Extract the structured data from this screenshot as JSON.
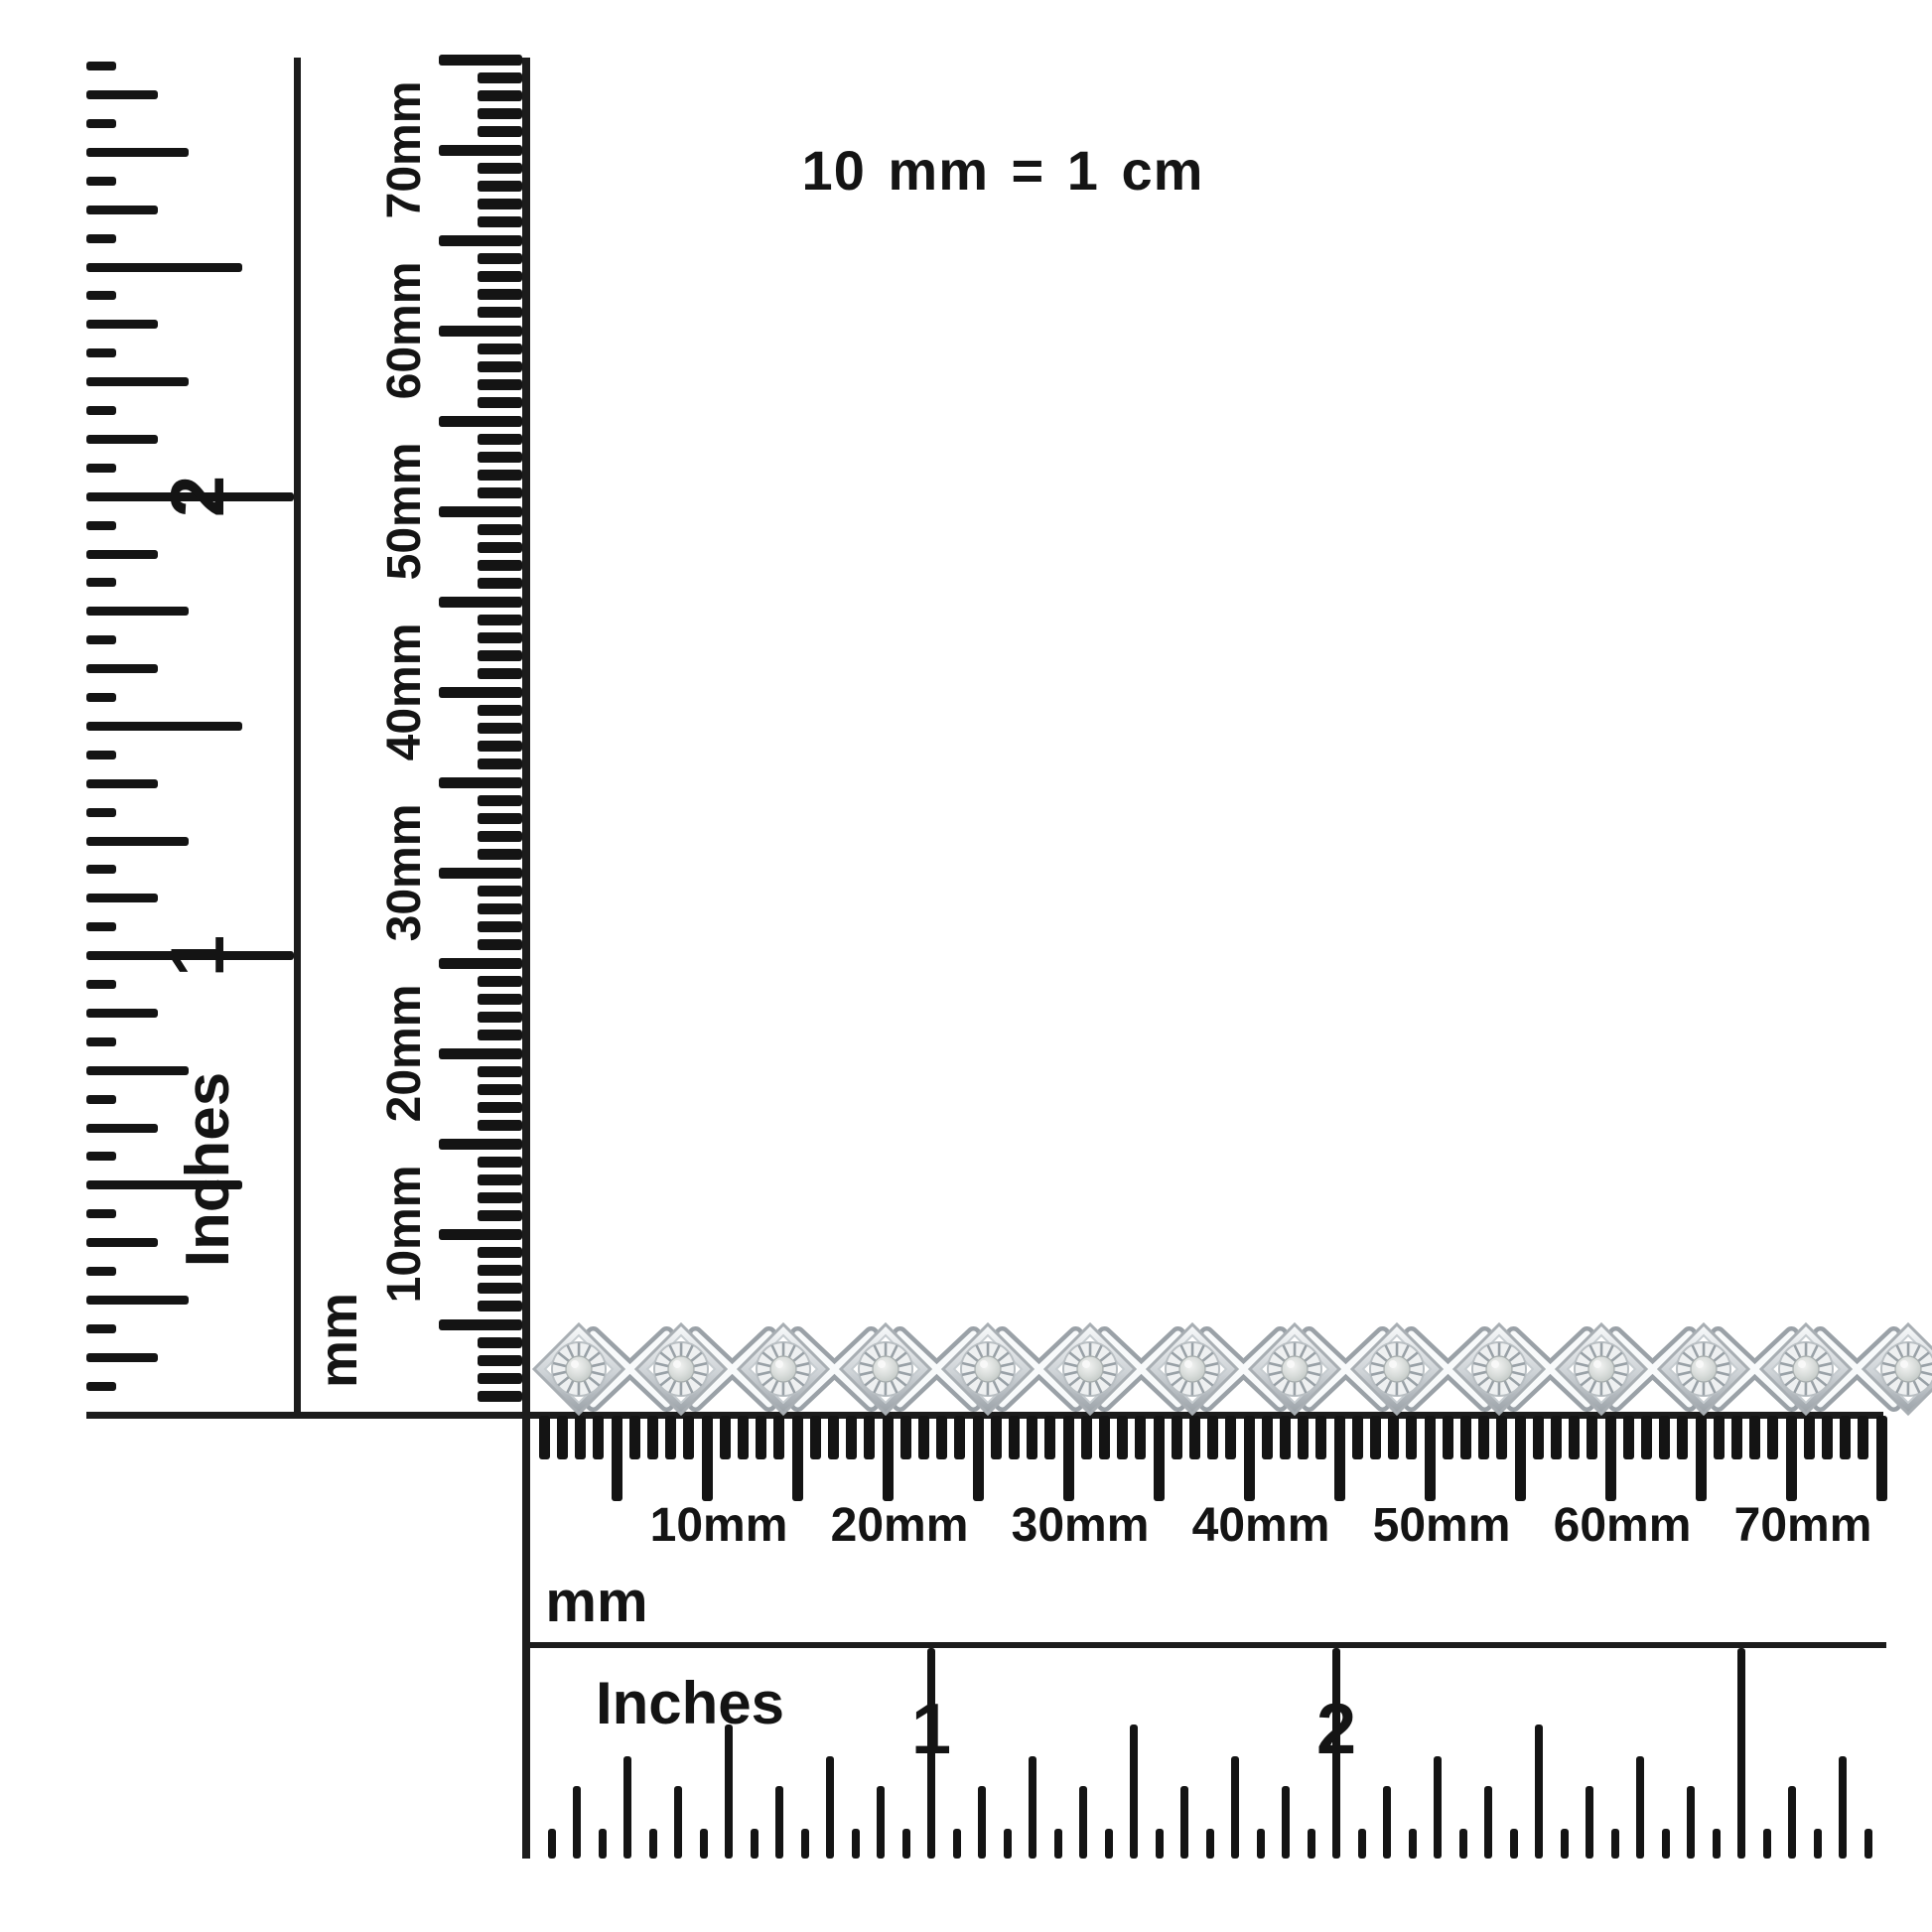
{
  "note": {
    "text": "10 mm = 1 cm"
  },
  "product": {
    "type": "bracelet",
    "description": "Silver X-link tennis bracelet with round miracle-plate set diamonds, shown against mm and inch rulers",
    "visible_link_count": 14
  },
  "colors": {
    "ink": "#141414",
    "background": "#ffffff",
    "metal_light": "#f8fafb",
    "metal_mid": "#cdd2d6",
    "metal_shadow": "#9aa1a7",
    "metal_edge": "#a8aeb3",
    "metal_inner": "#eef0f1",
    "spoke": "#99a1a7",
    "stone_light": "#f3f4f3",
    "stone_mid": "#d7dbd9",
    "stone_dark": "#bcc3c0"
  },
  "vertical_inches_ruler": {
    "unit_label": "Inches",
    "numerals": [
      "1",
      "2"
    ],
    "range_inches": 3,
    "ticks_per_inch": 16
  },
  "vertical_mm_ruler": {
    "unit_label": "mm",
    "labels": [
      "10mm",
      "20mm",
      "30mm",
      "40mm",
      "50mm",
      "60mm",
      "70mm"
    ],
    "range_mm": 75,
    "minor_every_mm": 1,
    "major_every_mm": 5
  },
  "horizontal_mm_ruler": {
    "unit_label": "mm",
    "labels": [
      "10mm",
      "20mm",
      "30mm",
      "40mm",
      "50mm",
      "60mm",
      "70mm"
    ],
    "range_mm": 75,
    "minor_every_mm": 1,
    "major_every_mm": 5
  },
  "horizontal_inches_ruler": {
    "unit_label": "Inches",
    "numerals": [
      "1",
      "2"
    ],
    "range_inches": 3.3,
    "ticks_per_inch": 16
  }
}
